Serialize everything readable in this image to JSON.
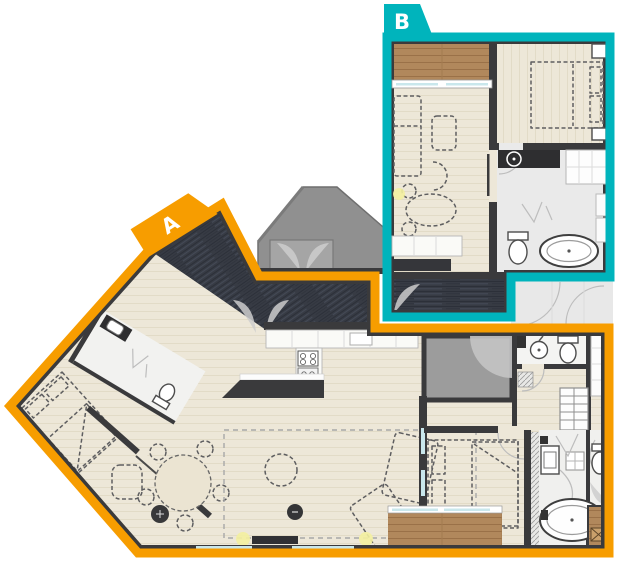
{
  "plan": {
    "unit_a": {
      "label": "A",
      "outline_color": "#F79D00"
    },
    "unit_b": {
      "label": "B",
      "outline_color": "#00B4BC"
    }
  },
  "palette": {
    "background": "#FFFFFF",
    "walls": "#3A3A3C",
    "corridor_floor": "#373B44",
    "room_floor": "#EDE7D8",
    "bathroom_floor": "#EFEFEF",
    "wood_deck": "#B1885C",
    "core_gray": "#909090",
    "glass": "#C9E7EC"
  }
}
